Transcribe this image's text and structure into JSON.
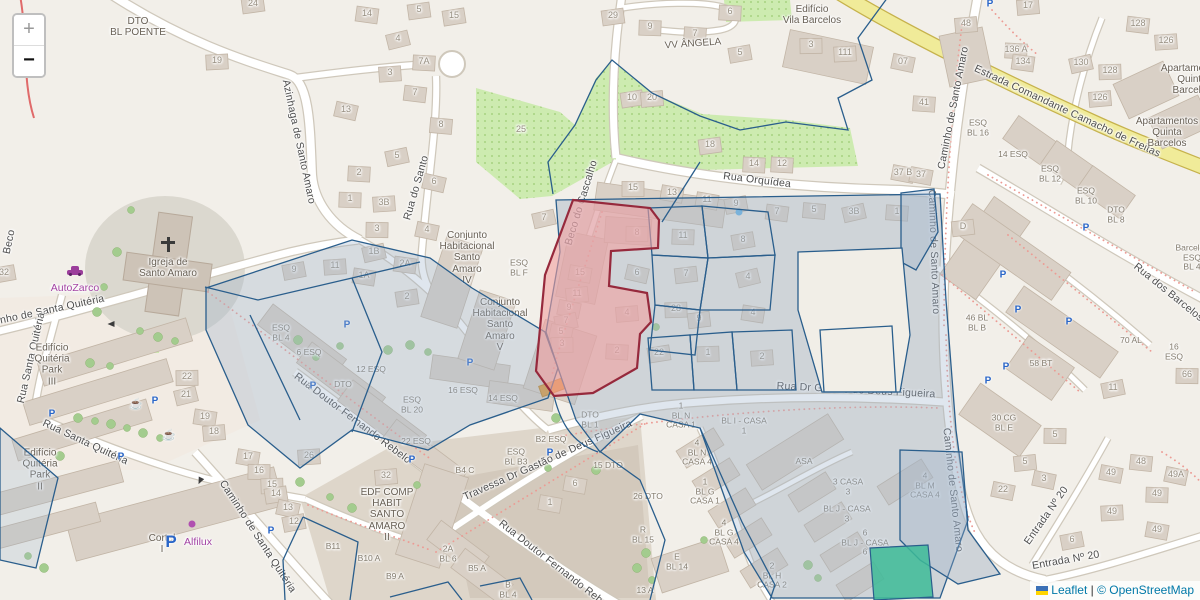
{
  "attribution": {
    "leaflet": "Leaflet",
    "sep": "|",
    "osm": "© OpenStreetMap"
  },
  "controls": {
    "zoom_in": "+",
    "zoom_out": "−"
  },
  "colors": {
    "overlay_blue": "#2a5e8c",
    "overlay_blue_fill": "rgba(155,178,202,0.32)",
    "highlight_red": "#96293c",
    "highlight_red_fill": "rgba(242,160,160,0.6)",
    "teal": "#3dbb98",
    "road_yellow": "#f0eb99",
    "link_blue": "#0078A8",
    "poi_purple": "#a343a3"
  },
  "map": {
    "streets": [
      {
        "t": "Beco",
        "x": 10,
        "y": 242,
        "r": -78
      },
      {
        "t": "Azinhaga de Santo Amaro",
        "x": 298,
        "y": 142,
        "r": 78
      },
      {
        "t": "Rua do Santo",
        "x": 417,
        "y": 188,
        "r": -74
      },
      {
        "t": "Beco do Cascalho",
        "x": 582,
        "y": 203,
        "r": -73
      },
      {
        "t": "Rua Orquídea",
        "x": 757,
        "y": 181,
        "r": 7
      },
      {
        "t": "Estrada Comandante Camacho de Freitas",
        "x": 1067,
        "y": 112,
        "r": 25
      },
      {
        "t": "Caminho de Santo Amaro",
        "x": 954,
        "y": 108,
        "r": -79
      },
      {
        "t": "Caminho de Santo Amaro",
        "x": 933,
        "y": 252,
        "r": 88
      },
      {
        "t": "Caminho de Santo Amaro",
        "x": 952,
        "y": 490,
        "r": 84
      },
      {
        "t": "Rua dos Barcelos",
        "x": 1168,
        "y": 293,
        "r": 39
      },
      {
        "t": "Rua Dr Gastão de Deus Figueira",
        "x": 856,
        "y": 391,
        "r": 3
      },
      {
        "t": "Travessa Dr Gastão de Deus Figueira",
        "x": 548,
        "y": 461,
        "r": -24
      },
      {
        "t": "Rua Doutor Fernando Rebelo",
        "x": 352,
        "y": 419,
        "r": 37
      },
      {
        "t": "Rua Doutor Fernando Rebelo",
        "x": 556,
        "y": 567,
        "r": 38
      },
      {
        "t": "Caminho de Santa Quitéria",
        "x": 40,
        "y": 313,
        "r": -12
      },
      {
        "t": "Rua Santa Quitéria",
        "x": 32,
        "y": 358,
        "r": -77
      },
      {
        "t": "Rua Santa Quitéria",
        "x": 85,
        "y": 443,
        "r": 25
      },
      {
        "t": "Caminho de Santa Quitéria",
        "x": 257,
        "y": 537,
        "r": 57
      },
      {
        "t": "Entrada Nº 20",
        "x": 1047,
        "y": 516,
        "r": -55
      },
      {
        "t": "Entrada Nº 20",
        "x": 1066,
        "y": 561,
        "r": -10
      }
    ],
    "places": [
      {
        "t": "DTO\nBL POENTE",
        "x": 138,
        "y": 27
      },
      {
        "t": "Edifício\nVila Barcelos",
        "x": 812,
        "y": 15
      },
      {
        "t": "Apartamentos\nQuinta\nBarcelos",
        "x": 1192,
        "y": 80
      },
      {
        "t": "Apartamentos\nQuinta\nBarcelos",
        "x": 1167,
        "y": 133
      },
      {
        "t": "Igreja de\nSanto Amaro",
        "x": 168,
        "y": 268
      },
      {
        "t": "VV ÂNGELA",
        "x": 693,
        "y": 44,
        "r": -4
      },
      {
        "t": "Conjunto\nHabitacional\nSanto\nAmaro\nIV",
        "x": 467,
        "y": 258
      },
      {
        "t": "Conjunto\nHabitacional\nSanto\nAmaro\nV",
        "x": 500,
        "y": 325
      },
      {
        "t": "Edifício\nQuitéria\nPark\nIII",
        "x": 52,
        "y": 365
      },
      {
        "t": "Edifício\nQuitéria\nPark\nII",
        "x": 40,
        "y": 470
      },
      {
        "t": "Cortel\nI",
        "x": 162,
        "y": 544
      },
      {
        "t": "EDF COMP\nHABIT\nSANTO\nAMARO\nII",
        "x": 387,
        "y": 515
      },
      {
        "t": "ESQ\nBL F",
        "x": 519,
        "y": 268,
        "sm": 1
      },
      {
        "t": "ESQ\nBL 16",
        "x": 978,
        "y": 128,
        "sm": 1
      },
      {
        "t": "14 ESQ",
        "x": 1013,
        "y": 155,
        "sm": 1
      },
      {
        "t": "ESQ\nBL 12",
        "x": 1050,
        "y": 174,
        "sm": 1
      },
      {
        "t": "ESQ\nBL 10",
        "x": 1086,
        "y": 196,
        "sm": 1
      },
      {
        "t": "DTO\nBL 8",
        "x": 1116,
        "y": 215,
        "sm": 1
      },
      {
        "t": "Barcelos\nESQ\nBL 4",
        "x": 1192,
        "y": 258,
        "sm": 1
      },
      {
        "t": "ESQ\nBL 4",
        "x": 281,
        "y": 333,
        "sm": 1
      },
      {
        "t": "6 ESQ",
        "x": 309,
        "y": 353,
        "sm": 1
      },
      {
        "t": "12 ESQ",
        "x": 371,
        "y": 370,
        "sm": 1
      },
      {
        "t": "DTO",
        "x": 343,
        "y": 385,
        "sm": 1
      },
      {
        "t": "ESQ\nBL 20",
        "x": 412,
        "y": 405,
        "sm": 1
      },
      {
        "t": "22 ESQ",
        "x": 416,
        "y": 442,
        "sm": 1
      },
      {
        "t": "16 ESQ",
        "x": 463,
        "y": 391,
        "sm": 1
      },
      {
        "t": "14 ESQ",
        "x": 503,
        "y": 399,
        "sm": 1
      },
      {
        "t": "DTO\nBL 1",
        "x": 590,
        "y": 420,
        "sm": 1
      },
      {
        "t": "B2 ESQ",
        "x": 551,
        "y": 440,
        "sm": 1
      },
      {
        "t": "ESQ\nBL B3",
        "x": 516,
        "y": 457,
        "sm": 1
      },
      {
        "t": "B4 C",
        "x": 465,
        "y": 471,
        "sm": 1
      },
      {
        "t": "B11",
        "x": 333,
        "y": 547,
        "sm": 1
      },
      {
        "t": "B10 A",
        "x": 369,
        "y": 559,
        "sm": 1
      },
      {
        "t": "B9 A",
        "x": 395,
        "y": 577,
        "sm": 1
      },
      {
        "t": "2A\nBL 6",
        "x": 448,
        "y": 554,
        "sm": 1
      },
      {
        "t": "B5 A",
        "x": 477,
        "y": 569,
        "sm": 1
      },
      {
        "t": "B\nBL 4",
        "x": 508,
        "y": 590,
        "sm": 1
      },
      {
        "t": "15 DTO",
        "x": 608,
        "y": 466,
        "sm": 1
      },
      {
        "t": "26 DTO",
        "x": 648,
        "y": 497,
        "sm": 1
      },
      {
        "t": "R\nBL 15",
        "x": 643,
        "y": 535,
        "sm": 1
      },
      {
        "t": "E\nBL 14",
        "x": 677,
        "y": 562,
        "sm": 1
      },
      {
        "t": "13 A",
        "x": 645,
        "y": 591,
        "sm": 1
      },
      {
        "t": "1\nBL N\nCASA 1",
        "x": 681,
        "y": 416,
        "sm": 1
      },
      {
        "t": "BL I - CASA\n1",
        "x": 744,
        "y": 426,
        "sm": 1
      },
      {
        "t": "4\nBL N\nCASA 4",
        "x": 697,
        "y": 453,
        "sm": 1
      },
      {
        "t": "1\nBL G\nCASA 1",
        "x": 705,
        "y": 492,
        "sm": 1
      },
      {
        "t": "4\nBL G\nCASA 4",
        "x": 724,
        "y": 533,
        "sm": 1
      },
      {
        "t": "2\nBL H\nCASA 2",
        "x": 772,
        "y": 576,
        "sm": 1
      },
      {
        "t": "ASA",
        "x": 804,
        "y": 462,
        "sm": 1
      },
      {
        "t": "3 CASA\n3",
        "x": 848,
        "y": 487,
        "sm": 1
      },
      {
        "t": "BL J - CASA\n3",
        "x": 847,
        "y": 514,
        "sm": 1
      },
      {
        "t": "6\nBL J - CASA\n6",
        "x": 865,
        "y": 543,
        "sm": 1
      },
      {
        "t": "4\nBL M\nCASA 4",
        "x": 925,
        "y": 486,
        "sm": 1
      },
      {
        "t": "46 BL\nBL B",
        "x": 977,
        "y": 323,
        "sm": 1
      },
      {
        "t": "70 AL",
        "x": 1131,
        "y": 341,
        "sm": 1
      },
      {
        "t": "16 ESQ",
        "x": 1174,
        "y": 352,
        "sm": 1
      },
      {
        "t": "58 BT",
        "x": 1041,
        "y": 364,
        "sm": 1
      },
      {
        "t": "30 CG\nBL E",
        "x": 1004,
        "y": 423,
        "sm": 1
      }
    ],
    "numbers": [
      {
        "t": "19",
        "x": 217,
        "y": 60
      },
      {
        "t": "24",
        "x": 253,
        "y": 3
      },
      {
        "t": "14",
        "x": 367,
        "y": 13
      },
      {
        "t": "5",
        "x": 419,
        "y": 9
      },
      {
        "t": "15",
        "x": 454,
        "y": 15
      },
      {
        "t": "4",
        "x": 398,
        "y": 38
      },
      {
        "t": "7A",
        "x": 424,
        "y": 61
      },
      {
        "t": "3",
        "x": 390,
        "y": 72
      },
      {
        "t": "7",
        "x": 415,
        "y": 92
      },
      {
        "t": "13",
        "x": 346,
        "y": 109
      },
      {
        "t": "8",
        "x": 441,
        "y": 124
      },
      {
        "t": "25",
        "x": 521,
        "y": 129
      },
      {
        "t": "29",
        "x": 613,
        "y": 15
      },
      {
        "t": "9",
        "x": 650,
        "y": 26
      },
      {
        "t": "6",
        "x": 730,
        "y": 11
      },
      {
        "t": "7",
        "x": 695,
        "y": 33
      },
      {
        "t": "5",
        "x": 740,
        "y": 52
      },
      {
        "t": "3",
        "x": 811,
        "y": 44
      },
      {
        "t": "111",
        "x": 845,
        "y": 52
      },
      {
        "t": "10",
        "x": 632,
        "y": 97
      },
      {
        "t": "20",
        "x": 652,
        "y": 97
      },
      {
        "t": "18",
        "x": 710,
        "y": 144
      },
      {
        "t": "17",
        "x": 1028,
        "y": 5
      },
      {
        "t": "48",
        "x": 966,
        "y": 23
      },
      {
        "t": "136 A",
        "x": 1016,
        "y": 49
      },
      {
        "t": "134",
        "x": 1023,
        "y": 61
      },
      {
        "t": "130",
        "x": 1081,
        "y": 62
      },
      {
        "t": "128",
        "x": 1138,
        "y": 23
      },
      {
        "t": "126",
        "x": 1166,
        "y": 40
      },
      {
        "t": "128",
        "x": 1110,
        "y": 70
      },
      {
        "t": "126",
        "x": 1100,
        "y": 97
      },
      {
        "t": "07",
        "x": 903,
        "y": 61
      },
      {
        "t": "41",
        "x": 924,
        "y": 102
      },
      {
        "t": "37 B",
        "x": 903,
        "y": 172
      },
      {
        "t": "37",
        "x": 921,
        "y": 174
      },
      {
        "t": "15",
        "x": 633,
        "y": 187
      },
      {
        "t": "13",
        "x": 672,
        "y": 192
      },
      {
        "t": "11",
        "x": 707,
        "y": 199
      },
      {
        "t": "9",
        "x": 736,
        "y": 203
      },
      {
        "t": "14",
        "x": 754,
        "y": 163
      },
      {
        "t": "12",
        "x": 782,
        "y": 163
      },
      {
        "t": "7",
        "x": 777,
        "y": 211
      },
      {
        "t": "5",
        "x": 814,
        "y": 209
      },
      {
        "t": "3B",
        "x": 854,
        "y": 211
      },
      {
        "t": "1",
        "x": 897,
        "y": 211
      },
      {
        "t": "5",
        "x": 397,
        "y": 155
      },
      {
        "t": "2",
        "x": 359,
        "y": 172
      },
      {
        "t": "6",
        "x": 434,
        "y": 181
      },
      {
        "t": "1",
        "x": 350,
        "y": 198
      },
      {
        "t": "3B",
        "x": 384,
        "y": 202
      },
      {
        "t": "3",
        "x": 377,
        "y": 228
      },
      {
        "t": "4",
        "x": 427,
        "y": 229
      },
      {
        "t": "1B",
        "x": 374,
        "y": 251
      },
      {
        "t": "2A",
        "x": 405,
        "y": 263
      },
      {
        "t": "11",
        "x": 335,
        "y": 265
      },
      {
        "t": "1A",
        "x": 364,
        "y": 275
      },
      {
        "t": "2",
        "x": 407,
        "y": 296
      },
      {
        "t": "9",
        "x": 294,
        "y": 269
      },
      {
        "t": "32",
        "x": 4,
        "y": 272
      },
      {
        "t": "7",
        "x": 544,
        "y": 217
      },
      {
        "t": "8",
        "x": 637,
        "y": 232
      },
      {
        "t": "15",
        "x": 580,
        "y": 272
      },
      {
        "t": "11",
        "x": 577,
        "y": 293
      },
      {
        "t": "9",
        "x": 569,
        "y": 307
      },
      {
        "t": "7",
        "x": 566,
        "y": 320
      },
      {
        "t": "5",
        "x": 561,
        "y": 331
      },
      {
        "t": "3",
        "x": 562,
        "y": 343
      },
      {
        "t": "4",
        "x": 627,
        "y": 312
      },
      {
        "t": "2",
        "x": 617,
        "y": 350
      },
      {
        "t": "6",
        "x": 637,
        "y": 272
      },
      {
        "t": "11",
        "x": 683,
        "y": 235
      },
      {
        "t": "7",
        "x": 686,
        "y": 273
      },
      {
        "t": "8",
        "x": 743,
        "y": 239
      },
      {
        "t": "4",
        "x": 748,
        "y": 276
      },
      {
        "t": "28",
        "x": 676,
        "y": 308
      },
      {
        "t": "9",
        "x": 699,
        "y": 318
      },
      {
        "t": "27",
        "x": 862,
        "y": 281
      },
      {
        "t": "27",
        "x": 856,
        "y": 309
      },
      {
        "t": "22",
        "x": 659,
        "y": 352
      },
      {
        "t": "1",
        "x": 708,
        "y": 352
      },
      {
        "t": "2",
        "x": 762,
        "y": 356
      },
      {
        "t": "51",
        "x": 857,
        "y": 364
      },
      {
        "t": "4",
        "x": 753,
        "y": 312
      },
      {
        "t": "22",
        "x": 187,
        "y": 376
      },
      {
        "t": "21",
        "x": 186,
        "y": 394
      },
      {
        "t": "19",
        "x": 205,
        "y": 416
      },
      {
        "t": "18",
        "x": 214,
        "y": 431
      },
      {
        "t": "17",
        "x": 248,
        "y": 456
      },
      {
        "t": "16",
        "x": 259,
        "y": 470
      },
      {
        "t": "15",
        "x": 272,
        "y": 484
      },
      {
        "t": "14",
        "x": 276,
        "y": 493
      },
      {
        "t": "13",
        "x": 288,
        "y": 507
      },
      {
        "t": "12",
        "x": 294,
        "y": 521
      },
      {
        "t": "5",
        "x": 1025,
        "y": 461
      },
      {
        "t": "3",
        "x": 1044,
        "y": 478
      },
      {
        "t": "22",
        "x": 1003,
        "y": 489
      },
      {
        "t": "49",
        "x": 1111,
        "y": 472
      },
      {
        "t": "48",
        "x": 1141,
        "y": 461
      },
      {
        "t": "49A",
        "x": 1176,
        "y": 474
      },
      {
        "t": "49",
        "x": 1157,
        "y": 493
      },
      {
        "t": "49",
        "x": 1112,
        "y": 511
      },
      {
        "t": "49",
        "x": 1157,
        "y": 529
      },
      {
        "t": "6",
        "x": 1072,
        "y": 539
      },
      {
        "t": "11",
        "x": 1113,
        "y": 387
      },
      {
        "t": "66",
        "x": 1187,
        "y": 374
      },
      {
        "t": "5",
        "x": 1055,
        "y": 434
      },
      {
        "t": "26",
        "x": 309,
        "y": 455
      },
      {
        "t": "6",
        "x": 575,
        "y": 483
      },
      {
        "t": "1",
        "x": 550,
        "y": 502
      },
      {
        "t": "32",
        "x": 386,
        "y": 475
      },
      {
        "t": "D",
        "x": 963,
        "y": 226
      }
    ],
    "pois": [
      {
        "t": "AutoZarco",
        "x": 75,
        "y": 289
      },
      {
        "t": "Alfilux",
        "x": 198,
        "y": 543
      }
    ],
    "icons": [
      {
        "n": "church-cross",
        "x": 168,
        "y": 245
      },
      {
        "n": "car",
        "x": 75,
        "y": 271
      },
      {
        "n": "shop-dot",
        "x": 192,
        "y": 524
      },
      {
        "n": "water-dot",
        "x": 739,
        "y": 212
      },
      {
        "n": "cafe",
        "x": 136,
        "y": 404
      },
      {
        "n": "cafe",
        "x": 169,
        "y": 435
      },
      {
        "n": "parking",
        "x": 52,
        "y": 414
      },
      {
        "n": "parking",
        "x": 155,
        "y": 401
      },
      {
        "n": "parking",
        "x": 313,
        "y": 386
      },
      {
        "n": "parking",
        "x": 347,
        "y": 325
      },
      {
        "n": "parking",
        "x": 470,
        "y": 363
      },
      {
        "n": "parking",
        "x": 1086,
        "y": 228
      },
      {
        "n": "parking",
        "x": 1003,
        "y": 275
      },
      {
        "n": "parking",
        "x": 1018,
        "y": 310
      },
      {
        "n": "parking",
        "x": 1069,
        "y": 322
      },
      {
        "n": "parking",
        "x": 1006,
        "y": 367
      },
      {
        "n": "parking",
        "x": 988,
        "y": 381
      },
      {
        "n": "parking",
        "x": 121,
        "y": 457
      },
      {
        "n": "parking",
        "x": 271,
        "y": 531
      },
      {
        "n": "parking",
        "x": 412,
        "y": 460
      },
      {
        "n": "parking",
        "x": 550,
        "y": 453
      },
      {
        "n": "parking",
        "x": 990,
        "y": 4
      },
      {
        "n": "parking-big",
        "x": 171,
        "y": 542
      },
      {
        "n": "arrow",
        "x": 111,
        "y": 324,
        "r": 180
      },
      {
        "n": "arrow",
        "x": 200,
        "y": 481,
        "r": 115
      }
    ]
  }
}
